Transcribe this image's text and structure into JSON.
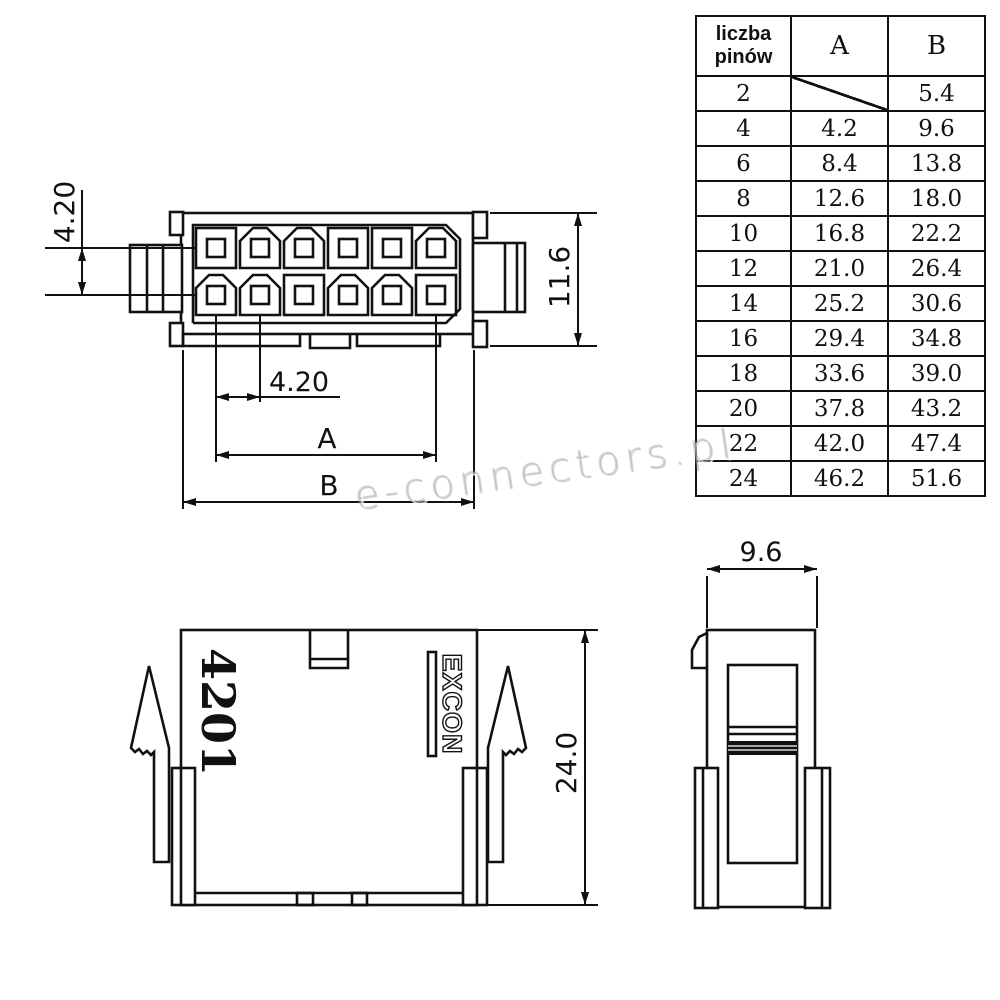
{
  "watermark": {
    "text": "e-connectors.pl"
  },
  "table": {
    "header": {
      "pins_line1": "liczba",
      "pins_line2": "pinów",
      "a": "A",
      "b": "B"
    },
    "rows": [
      {
        "pins": "2",
        "a": "",
        "b": "5.4"
      },
      {
        "pins": "4",
        "a": "4.2",
        "b": "9.6"
      },
      {
        "pins": "6",
        "a": "8.4",
        "b": "13.8"
      },
      {
        "pins": "8",
        "a": "12.6",
        "b": "18.0"
      },
      {
        "pins": "10",
        "a": "16.8",
        "b": "22.2"
      },
      {
        "pins": "12",
        "a": "21.0",
        "b": "26.4"
      },
      {
        "pins": "14",
        "a": "25.2",
        "b": "30.6"
      },
      {
        "pins": "16",
        "a": "29.4",
        "b": "34.8"
      },
      {
        "pins": "18",
        "a": "33.6",
        "b": "39.0"
      },
      {
        "pins": "20",
        "a": "37.8",
        "b": "43.2"
      },
      {
        "pins": "22",
        "a": "42.0",
        "b": "47.4"
      },
      {
        "pins": "24",
        "a": "46.2",
        "b": "51.6"
      }
    ]
  },
  "front_view": {
    "dim_row_pitch": "4.20",
    "dim_col_pitch": "4.20",
    "dim_height": "11.6",
    "dim_a": "A",
    "dim_b": "B"
  },
  "side_view": {
    "part_number": "4201",
    "brand": "EXCON",
    "dim_height": "24.0"
  },
  "profile_view": {
    "dim_width": "9.6"
  },
  "colors": {
    "line": "#111111",
    "background": "#ffffff",
    "watermark": "#b9b9b9"
  }
}
